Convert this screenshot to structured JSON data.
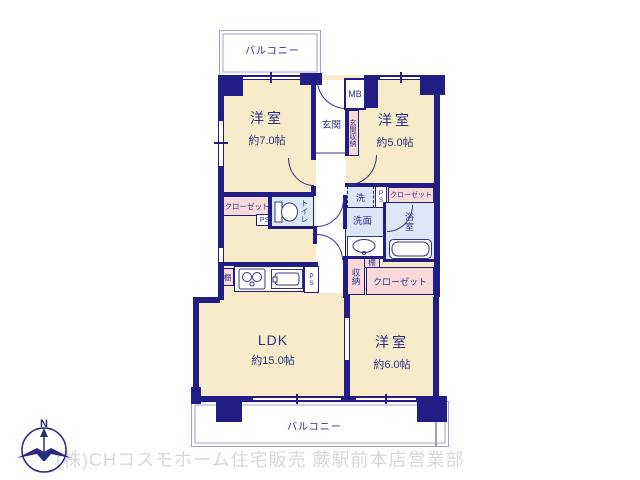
{
  "colors": {
    "wall": "#221c85",
    "room_fill": "#f7ebc9",
    "closet_fill": "#f9dadb",
    "wet_fill": "#dbe7f5",
    "balcony_line": "#a3a3cd",
    "label_text": "#2e2e85",
    "watermark_text": "#d8d8d8"
  },
  "balcony_top": {
    "label": "バルコニー"
  },
  "balcony_bottom": {
    "label": "バルコニー"
  },
  "rooms": {
    "west7": {
      "name": "洋室",
      "size": "約7.0帖"
    },
    "west5": {
      "name": "洋室",
      "size": "約5.0帖"
    },
    "west6": {
      "name": "洋室",
      "size": "約6.0帖"
    },
    "ldk": {
      "name": "LDK",
      "size": "約15.0帖"
    },
    "entrance": {
      "label": "玄関"
    },
    "entrance_storage": {
      "label": "玄関収納"
    },
    "meter_box": {
      "label": "MB"
    },
    "toilet": {
      "label": "トイレ"
    },
    "laundry": {
      "label": "洗"
    },
    "washroom": {
      "label": "洗面"
    },
    "bathroom": {
      "label": "浴室"
    },
    "storage": {
      "label": "収納"
    }
  },
  "fixtures": {
    "closet_west7": {
      "label": "クローゼット"
    },
    "closet_west5": {
      "label": "クローゼット"
    },
    "closet_west6": {
      "label": "クローゼット"
    },
    "shelf_kitchen": {
      "label": "棚"
    },
    "shelf_bathside": {
      "label": "棚"
    },
    "ps_hall": {
      "label": "PS"
    },
    "ps_laundry": {
      "label": "PS"
    },
    "ps_kitchen": {
      "label": "PS"
    }
  },
  "compass": {
    "label": "N"
  },
  "footer": {
    "watermark": "(株)CHコスモホーム住宅販売 蕨駅前本店営業部"
  }
}
